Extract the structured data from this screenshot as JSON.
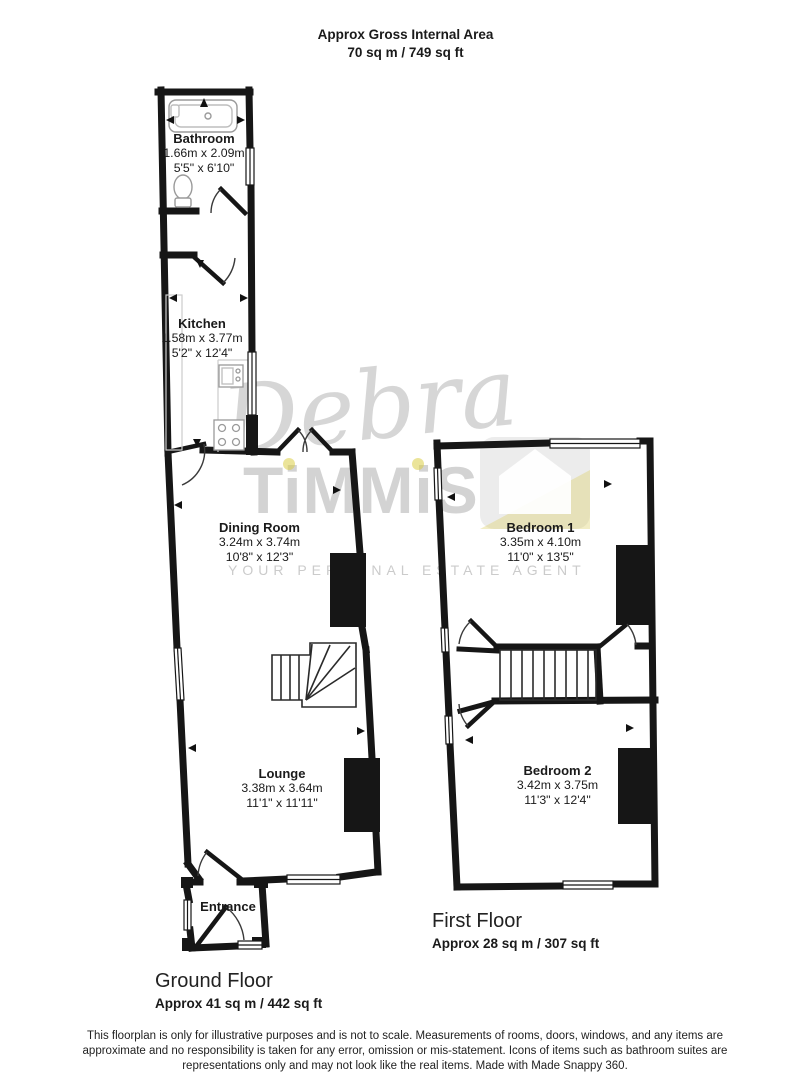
{
  "header": {
    "line1": "Approx Gross Internal Area",
    "line2": "70 sq m / 749 sq ft"
  },
  "watermark": {
    "script": "Debra",
    "brand": "TiMMiS",
    "tagline": "YOUR PERSONAL ESTATE AGENT"
  },
  "ground_floor": {
    "label": "Ground Floor",
    "area": "Approx 41 sq m / 442 sq ft",
    "rooms": [
      {
        "name": "Bathroom",
        "metric": "1.66m x 2.09m",
        "imperial": "5'5\" x 6'10\""
      },
      {
        "name": "Kitchen",
        "metric": "1.58m x 3.77m",
        "imperial": "5'2\" x 12'4\""
      },
      {
        "name": "Dining Room",
        "metric": "3.24m x 3.74m",
        "imperial": "10'8\" x 12'3\""
      },
      {
        "name": "Lounge",
        "metric": "3.38m x 3.64m",
        "imperial": "11'1\" x 11'11\""
      },
      {
        "name": "Entrance",
        "metric": "",
        "imperial": ""
      }
    ]
  },
  "first_floor": {
    "label": "First Floor",
    "area": "Approx 28 sq m / 307 sq ft",
    "rooms": [
      {
        "name": "Bedroom 1",
        "metric": "3.35m x 4.10m",
        "imperial": "11'0\" x 13'5\""
      },
      {
        "name": "Bedroom 2",
        "metric": "3.42m x 3.75m",
        "imperial": "11'3\" x 12'4\""
      }
    ]
  },
  "footer": {
    "disclaimer": "This floorplan is only for illustrative purposes and is not to scale. Measurements of rooms, doors, windows, and any items are approximate and no responsibility is taken for any error, omission or mis-statement. Icons of items such as bathroom suites are representations only and may not look like the real items. Made with Made Snappy 360."
  },
  "colors": {
    "walls": "#161616",
    "watermark_gray": "#787878",
    "watermark_yellow": "#dace46"
  }
}
